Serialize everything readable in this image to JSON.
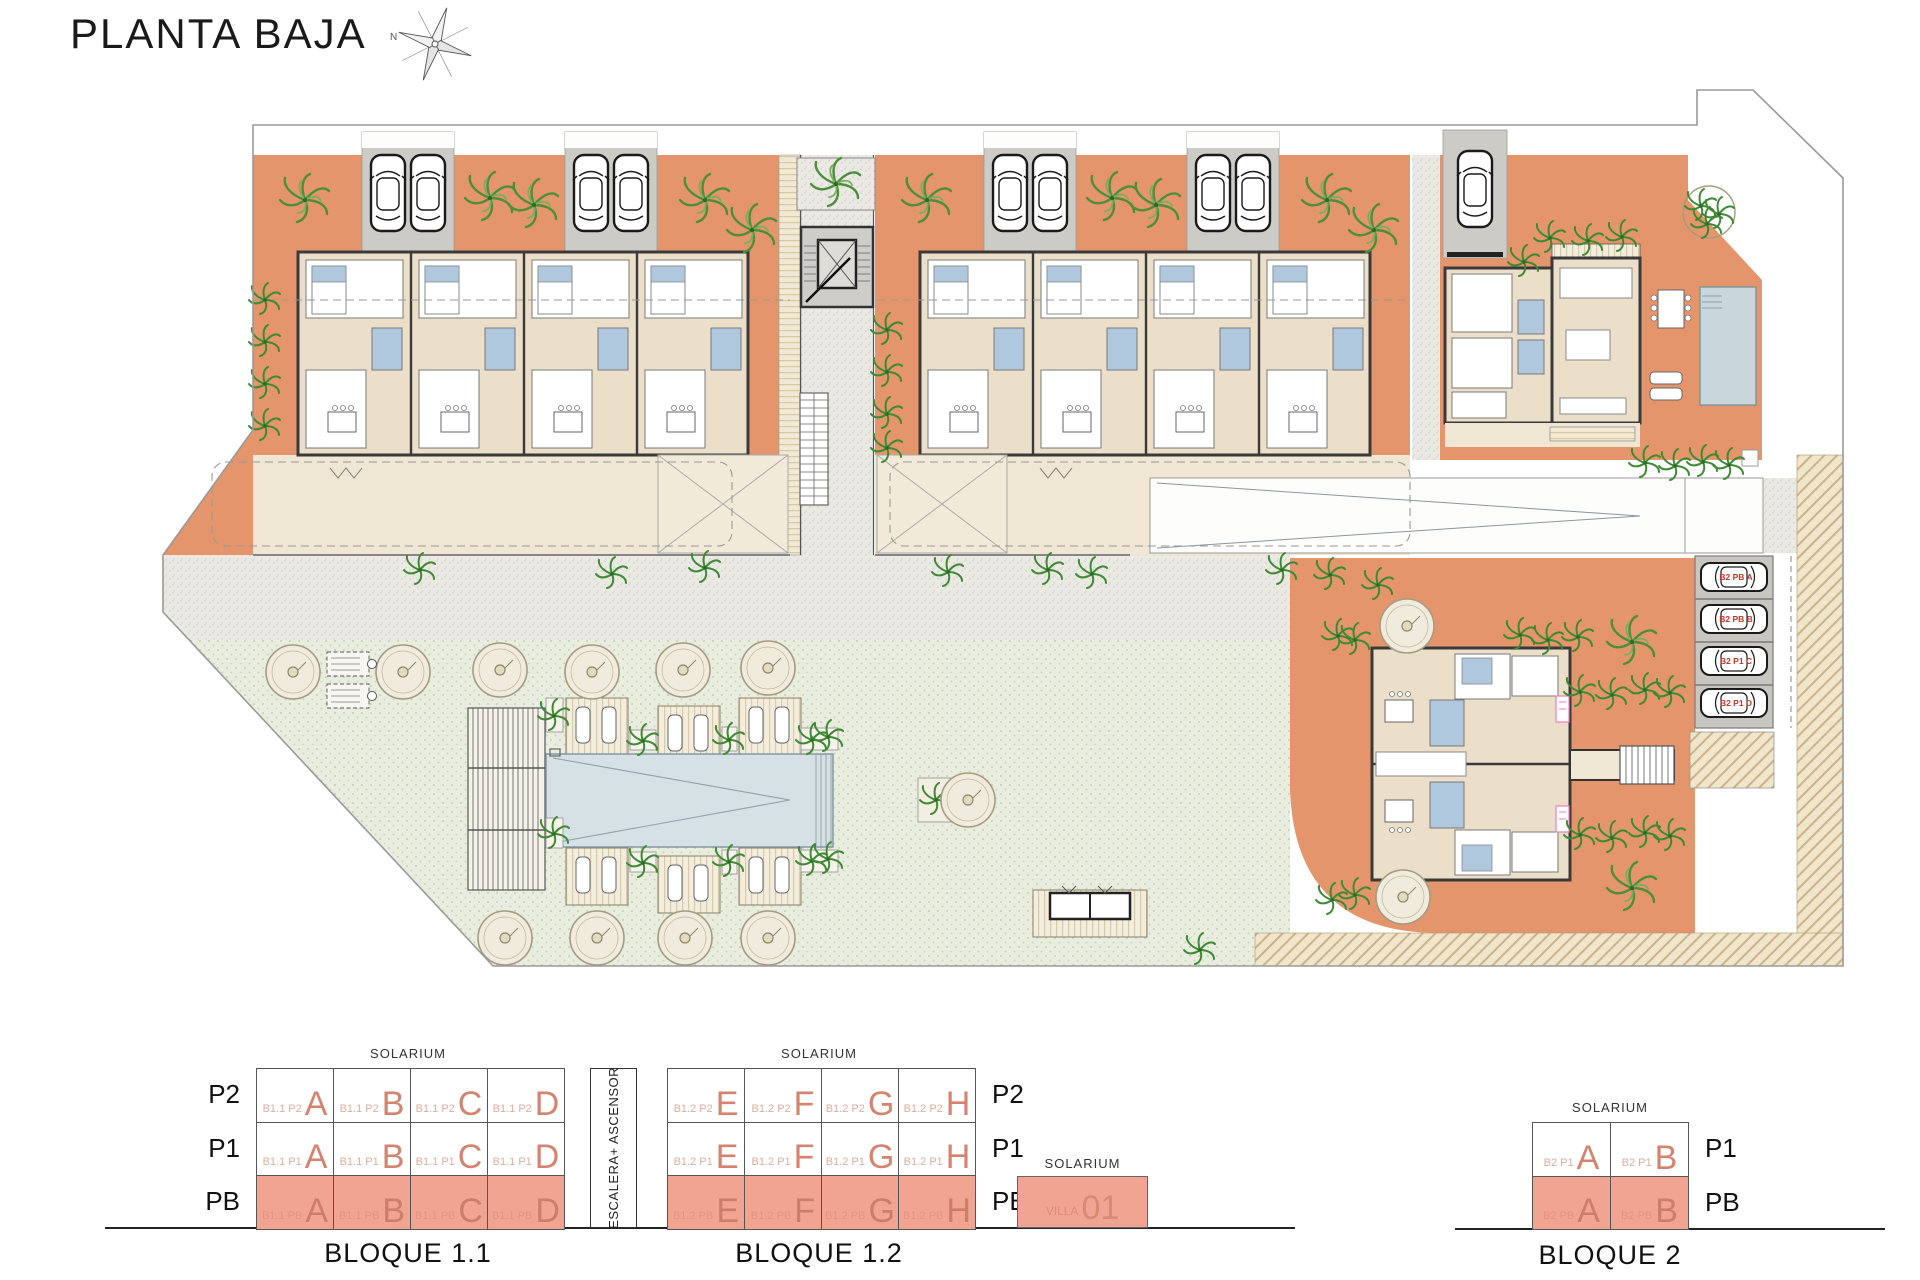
{
  "title": "PLANTA BAJA",
  "compass": {
    "north_label": "N"
  },
  "colors": {
    "terracotta": "#E5956C",
    "highlight_salmon": "#F2A492",
    "unit_letter": "#D5836E",
    "lawn": "#E8EDDF",
    "pool": "#D6E1E6",
    "garage_gray": "#CDCBC6",
    "parking_label_red": "#C3362B"
  },
  "plan": {
    "parking_labels": [
      "B2 PB A",
      "B2 PB B",
      "B2 P1 C",
      "B2 P1 D"
    ]
  },
  "legend": {
    "escalera_label": "ESCALERA+ ASCENSOR",
    "villa": {
      "solarium": "SOLARIUM",
      "code": "VILLA",
      "number": "01"
    },
    "blocks": [
      {
        "name": "BLOQUE 1.1",
        "solarium": "SOLARIUM",
        "label_side": "left",
        "floors": [
          {
            "label": "P2",
            "highlight": false,
            "cells": [
              {
                "code": "B1.1 P2",
                "letter": "A"
              },
              {
                "code": "B1.1 P2",
                "letter": "B"
              },
              {
                "code": "B1.1 P2",
                "letter": "C"
              },
              {
                "code": "B1.1 P2",
                "letter": "D"
              }
            ]
          },
          {
            "label": "P1",
            "highlight": false,
            "cells": [
              {
                "code": "B1.1 P1",
                "letter": "A"
              },
              {
                "code": "B1.1 P1",
                "letter": "B"
              },
              {
                "code": "B1.1 P1",
                "letter": "C"
              },
              {
                "code": "B1.1 P1",
                "letter": "D"
              }
            ]
          },
          {
            "label": "PB",
            "highlight": true,
            "cells": [
              {
                "code": "B1.1 PB",
                "letter": "A"
              },
              {
                "code": "B1.1 PB",
                "letter": "B"
              },
              {
                "code": "B1.1 PB",
                "letter": "C"
              },
              {
                "code": "B1.1 PB",
                "letter": "D"
              }
            ]
          }
        ]
      },
      {
        "name": "BLOQUE 1.2",
        "solarium": "SOLARIUM",
        "label_side": "right",
        "floors": [
          {
            "label": "P2",
            "highlight": false,
            "cells": [
              {
                "code": "B1.2 P2",
                "letter": "E"
              },
              {
                "code": "B1.2 P2",
                "letter": "F"
              },
              {
                "code": "B1.2 P2",
                "letter": "G"
              },
              {
                "code": "B1.2 P2",
                "letter": "H"
              }
            ]
          },
          {
            "label": "P1",
            "highlight": false,
            "cells": [
              {
                "code": "B1.2 P1",
                "letter": "E"
              },
              {
                "code": "B1.2 P1",
                "letter": "F"
              },
              {
                "code": "B1.2 P1",
                "letter": "G"
              },
              {
                "code": "B1.2 P1",
                "letter": "H"
              }
            ]
          },
          {
            "label": "PB",
            "highlight": true,
            "cells": [
              {
                "code": "B1.2 PB",
                "letter": "E"
              },
              {
                "code": "B1.2 PB",
                "letter": "F"
              },
              {
                "code": "B1.2 PB",
                "letter": "G"
              },
              {
                "code": "B1.2 PB",
                "letter": "H"
              }
            ]
          }
        ]
      },
      {
        "name": "BLOQUE 2",
        "solarium": "SOLARIUM",
        "label_side": "right",
        "floors": [
          {
            "label": "P1",
            "highlight": false,
            "cells": [
              {
                "code": "B2 P1",
                "letter": "A"
              },
              {
                "code": "B2 P1",
                "letter": "B"
              }
            ]
          },
          {
            "label": "PB",
            "highlight": true,
            "cells": [
              {
                "code": "B2 PB",
                "letter": "A"
              },
              {
                "code": "B2 PB",
                "letter": "B"
              }
            ]
          }
        ]
      }
    ]
  }
}
